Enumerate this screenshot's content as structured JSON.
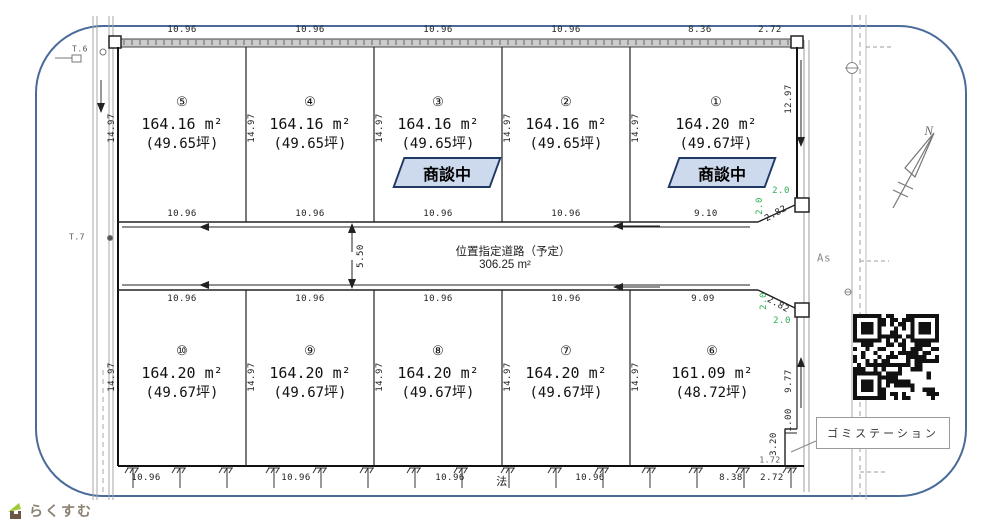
{
  "frame": {
    "border_color": "#4a6b9a"
  },
  "logo": {
    "text": "らくすむ"
  },
  "compass": {
    "north_label": "N"
  },
  "surface_label": "As",
  "slope_label": "法",
  "survey_labels": {
    "t6": "T.6",
    "t7": "T.7"
  },
  "status_banner": {
    "label": "商談中",
    "fill": "#cdd9ec",
    "border": "#1f3864"
  },
  "road": {
    "name": "位置指定道路（予定）",
    "area": "306.25 m²",
    "width": "5.50"
  },
  "garbage_station": {
    "label": "ゴミステーション"
  },
  "lots": [
    {
      "no": "①",
      "area": "164.20 m²",
      "tsubo": "(49.67坪)"
    },
    {
      "no": "②",
      "area": "164.16 m²",
      "tsubo": "(49.65坪)"
    },
    {
      "no": "③",
      "area": "164.16 m²",
      "tsubo": "(49.65坪)"
    },
    {
      "no": "④",
      "area": "164.16 m²",
      "tsubo": "(49.65坪)"
    },
    {
      "no": "⑤",
      "area": "164.16 m²",
      "tsubo": "(49.65坪)"
    },
    {
      "no": "⑥",
      "area": "161.09 m²",
      "tsubo": "(48.72坪)"
    },
    {
      "no": "⑦",
      "area": "164.20 m²",
      "tsubo": "(49.67坪)"
    },
    {
      "no": "⑧",
      "area": "164.20 m²",
      "tsubo": "(49.67坪)"
    },
    {
      "no": "⑨",
      "area": "164.20 m²",
      "tsubo": "(49.67坪)"
    },
    {
      "no": "⑩",
      "area": "164.20 m²",
      "tsubo": "(49.67坪)"
    }
  ],
  "dims": {
    "top": [
      "10.96",
      "10.96",
      "10.96",
      "10.96",
      "8.36",
      "2.72"
    ],
    "road_upper": [
      "10.96",
      "10.96",
      "10.96",
      "10.96",
      "9.10"
    ],
    "road_lower": [
      "10.96",
      "10.96",
      "10.96",
      "10.96",
      "9.09"
    ],
    "bottom": [
      "10.96",
      "10.96",
      "10.96",
      "10.96",
      "8.38",
      "2.72"
    ],
    "side": "14.97",
    "right_upper": "12.97",
    "right_lower": "9.77",
    "notch_step": "1.00",
    "notch_height": "3.20",
    "notch_offset": "1.72",
    "corner_leg": "2.0",
    "corner_hyp": "2.82"
  }
}
